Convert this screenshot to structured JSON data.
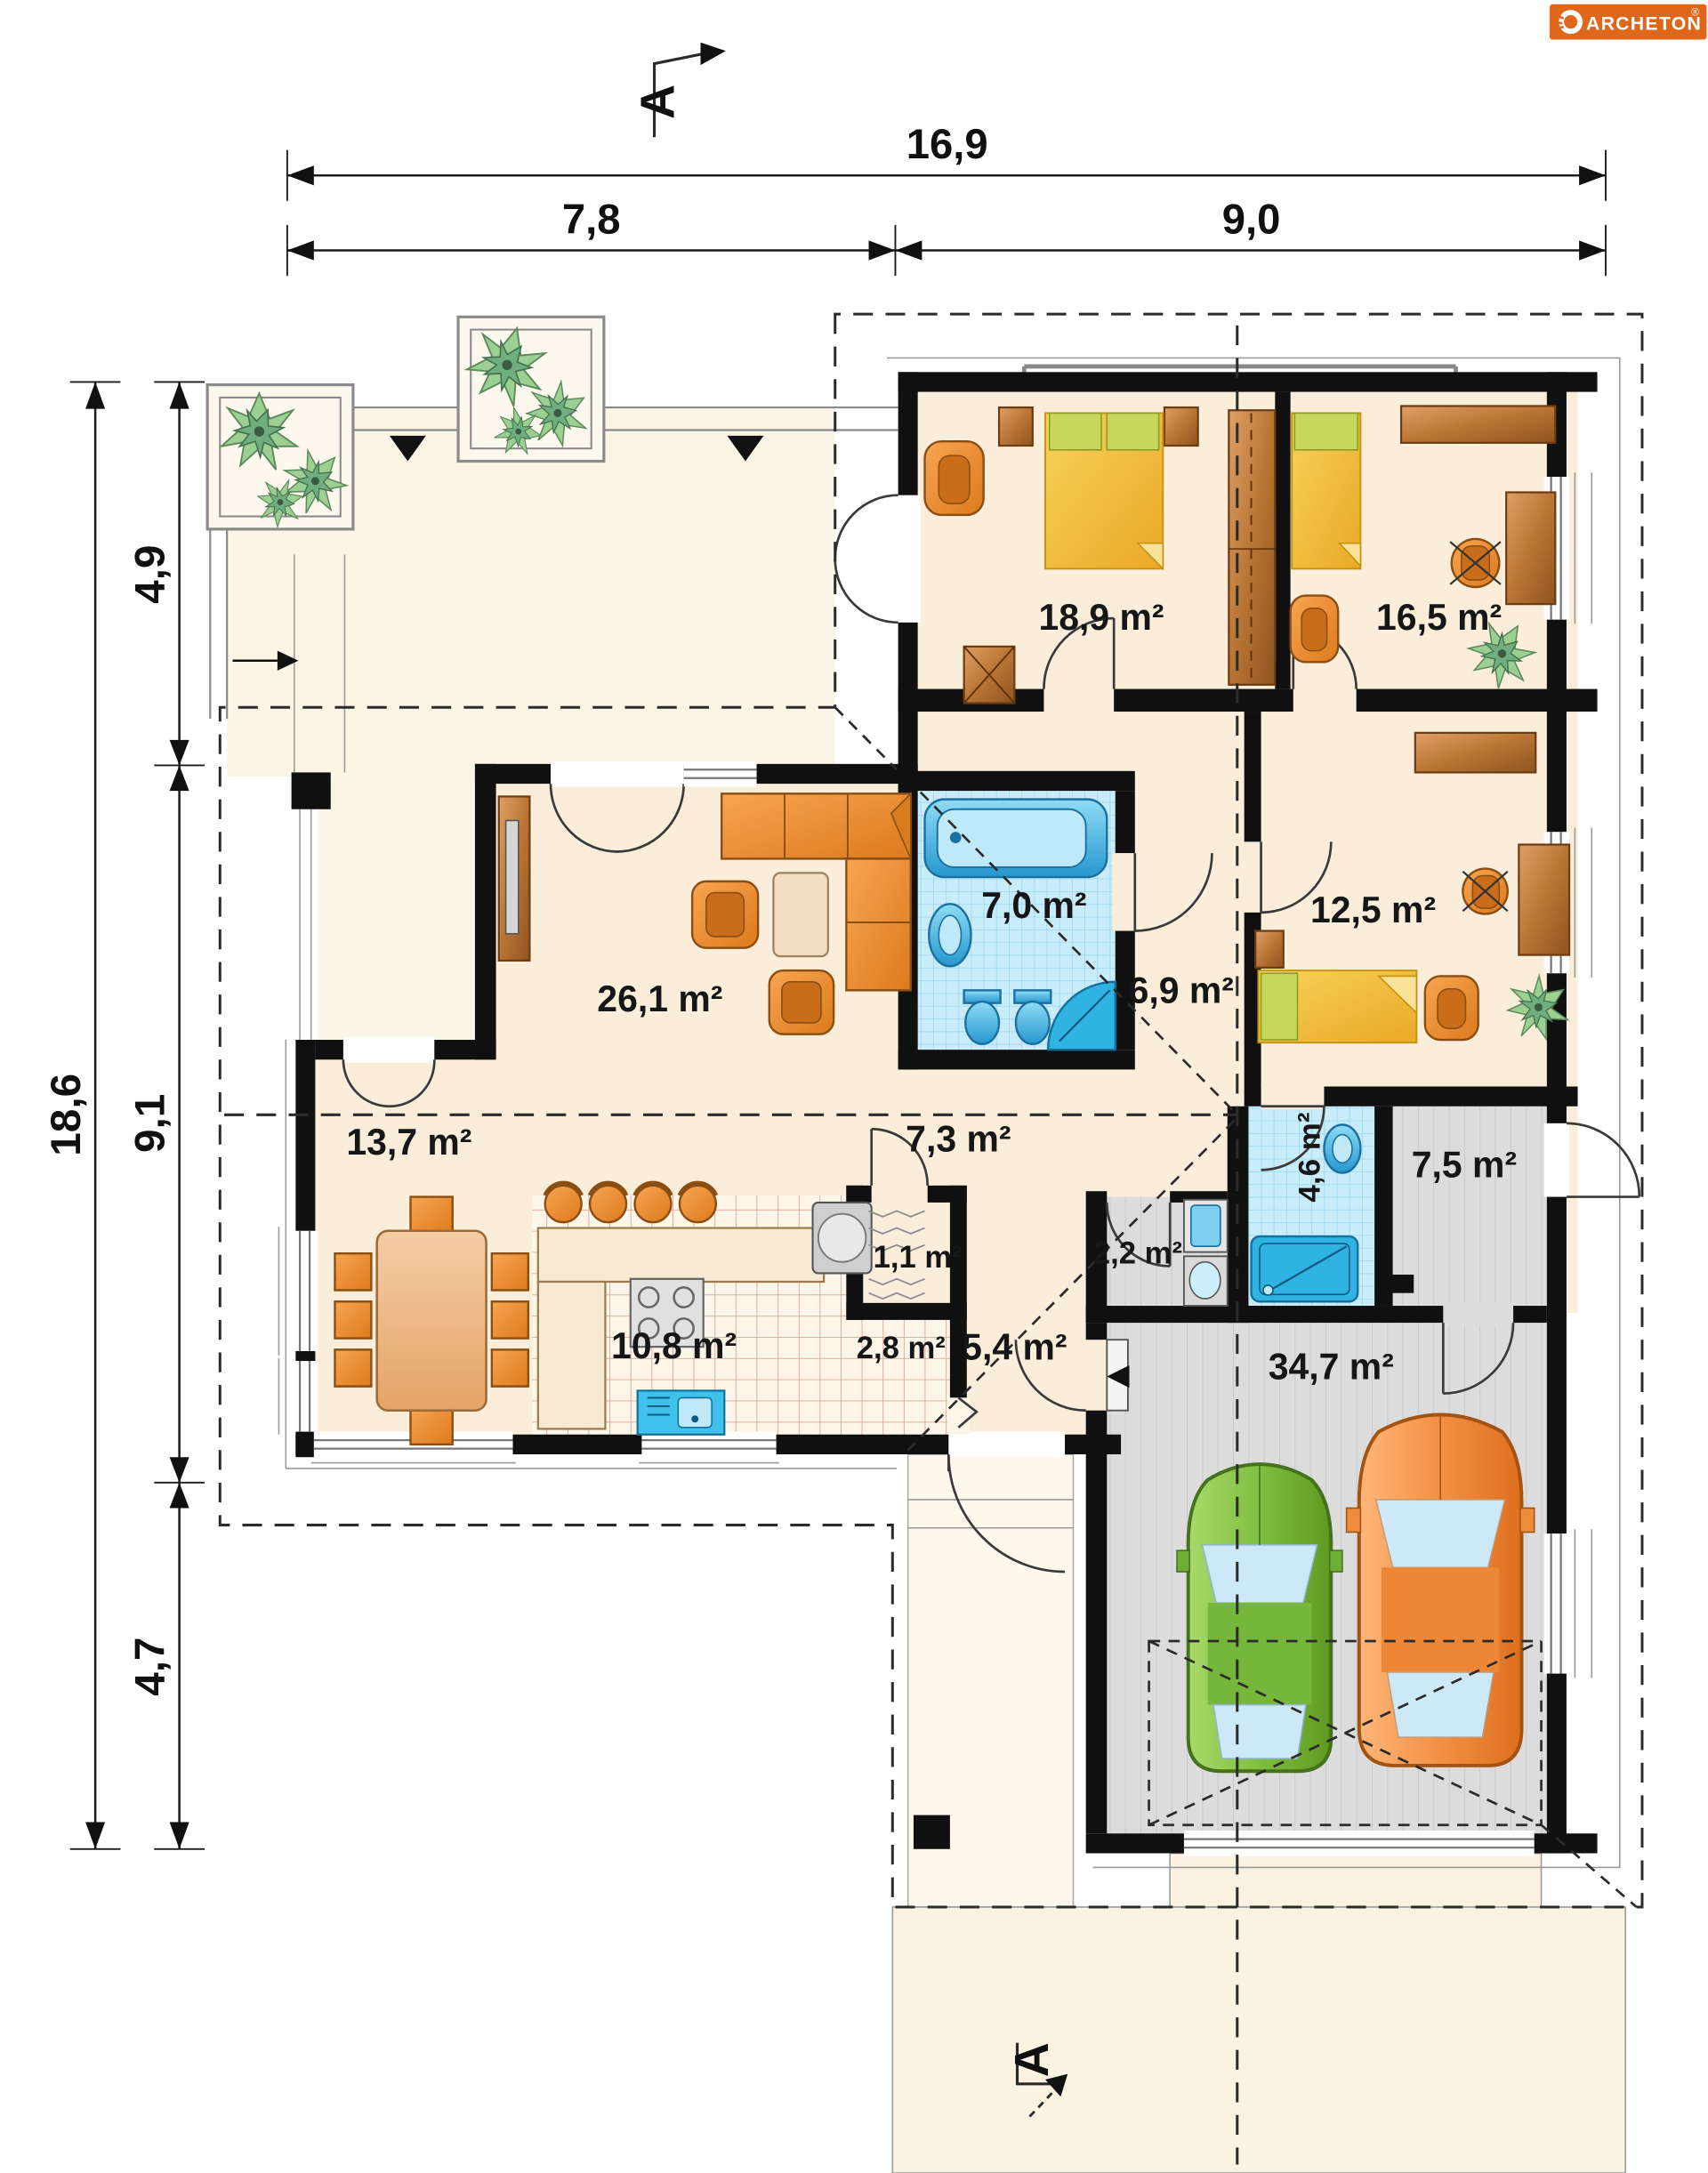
{
  "logo": {
    "brand": "ARCHETON",
    "registered": "®",
    "bg_color": "#E0661A",
    "text_color": "#FFFFFF"
  },
  "section_marker": {
    "top": "A",
    "bottom": "A"
  },
  "dimensions_m": {
    "top_total": "16,9",
    "top_left": "7,8",
    "top_right": "9,0",
    "left_total": "18,6",
    "left_top": "4,9",
    "left_middle": "9,1",
    "left_bottom": "4,7"
  },
  "rooms": [
    {
      "name": "bedroom-main",
      "area": "18,9 m²"
    },
    {
      "name": "bedroom-right",
      "area": "16,5 m²"
    },
    {
      "name": "bathroom-main",
      "area": "7,0 m²"
    },
    {
      "name": "hall-bedrooms",
      "area": "6,9 m²"
    },
    {
      "name": "bedroom-small",
      "area": "12,5 m²"
    },
    {
      "name": "living-room",
      "area": "26,1 m²"
    },
    {
      "name": "hall-central",
      "area": "7,3 m²"
    },
    {
      "name": "dining-room",
      "area": "13,7 m²"
    },
    {
      "name": "bathroom-small",
      "area": "4,6 m²"
    },
    {
      "name": "utility-room",
      "area": "7,5 m²"
    },
    {
      "name": "pantry",
      "area": "1,1 m²"
    },
    {
      "name": "laundry",
      "area": "2,2 m²"
    },
    {
      "name": "kitchen",
      "area": "10,8 m²"
    },
    {
      "name": "corridor",
      "area": "2,8 m²"
    },
    {
      "name": "entry-hall",
      "area": "5,4 m²"
    },
    {
      "name": "garage",
      "area": "34,7 m²"
    }
  ],
  "palette": {
    "floor_cream": "#faeedb",
    "terrace_cream": "#fcf4e4",
    "bath_blue": "#c8ecfa",
    "fixture_blue": "#2fb3e3",
    "gray_floor": "#dcdcdc",
    "kitchen_tile_line": "#e0968b",
    "wall_black": "#101010",
    "furniture_orange": "#ec8f33",
    "wood_brown": "#c07a3e",
    "bed_yellow": "#f2c22e",
    "pillow_green": "#c6d85c",
    "car_green": "#7fbf3f",
    "car_orange": "#f29044",
    "plant_green": "#9ccf92"
  }
}
